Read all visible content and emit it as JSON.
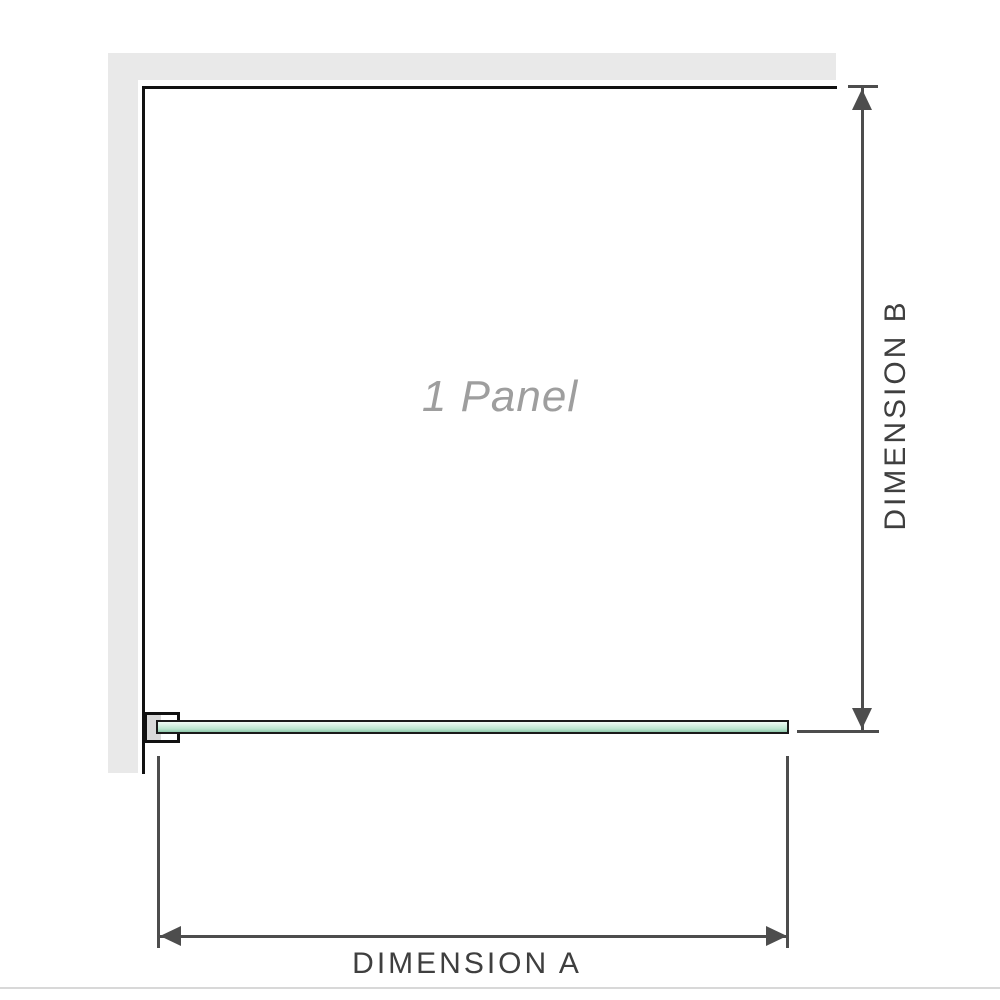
{
  "diagram": {
    "panel_label": "1 Panel",
    "dimension_a_label": "DIMENSION A",
    "dimension_b_label": "DIMENSION B"
  },
  "colors": {
    "wall": "#e9e9e9",
    "panel-border": "#111111",
    "glass-light": "#f0faf5",
    "glass-mid": "#b9e4cd",
    "glass-dark": "#8fc9ab",
    "glass-border": "#1a1a1a",
    "dimension-line": "#4d4d4d",
    "label-text": "#3f3f3f",
    "panel-text": "#9e9e9e",
    "bracket-fill": "#d9d9d9",
    "baseline": "#d8d8d8"
  }
}
